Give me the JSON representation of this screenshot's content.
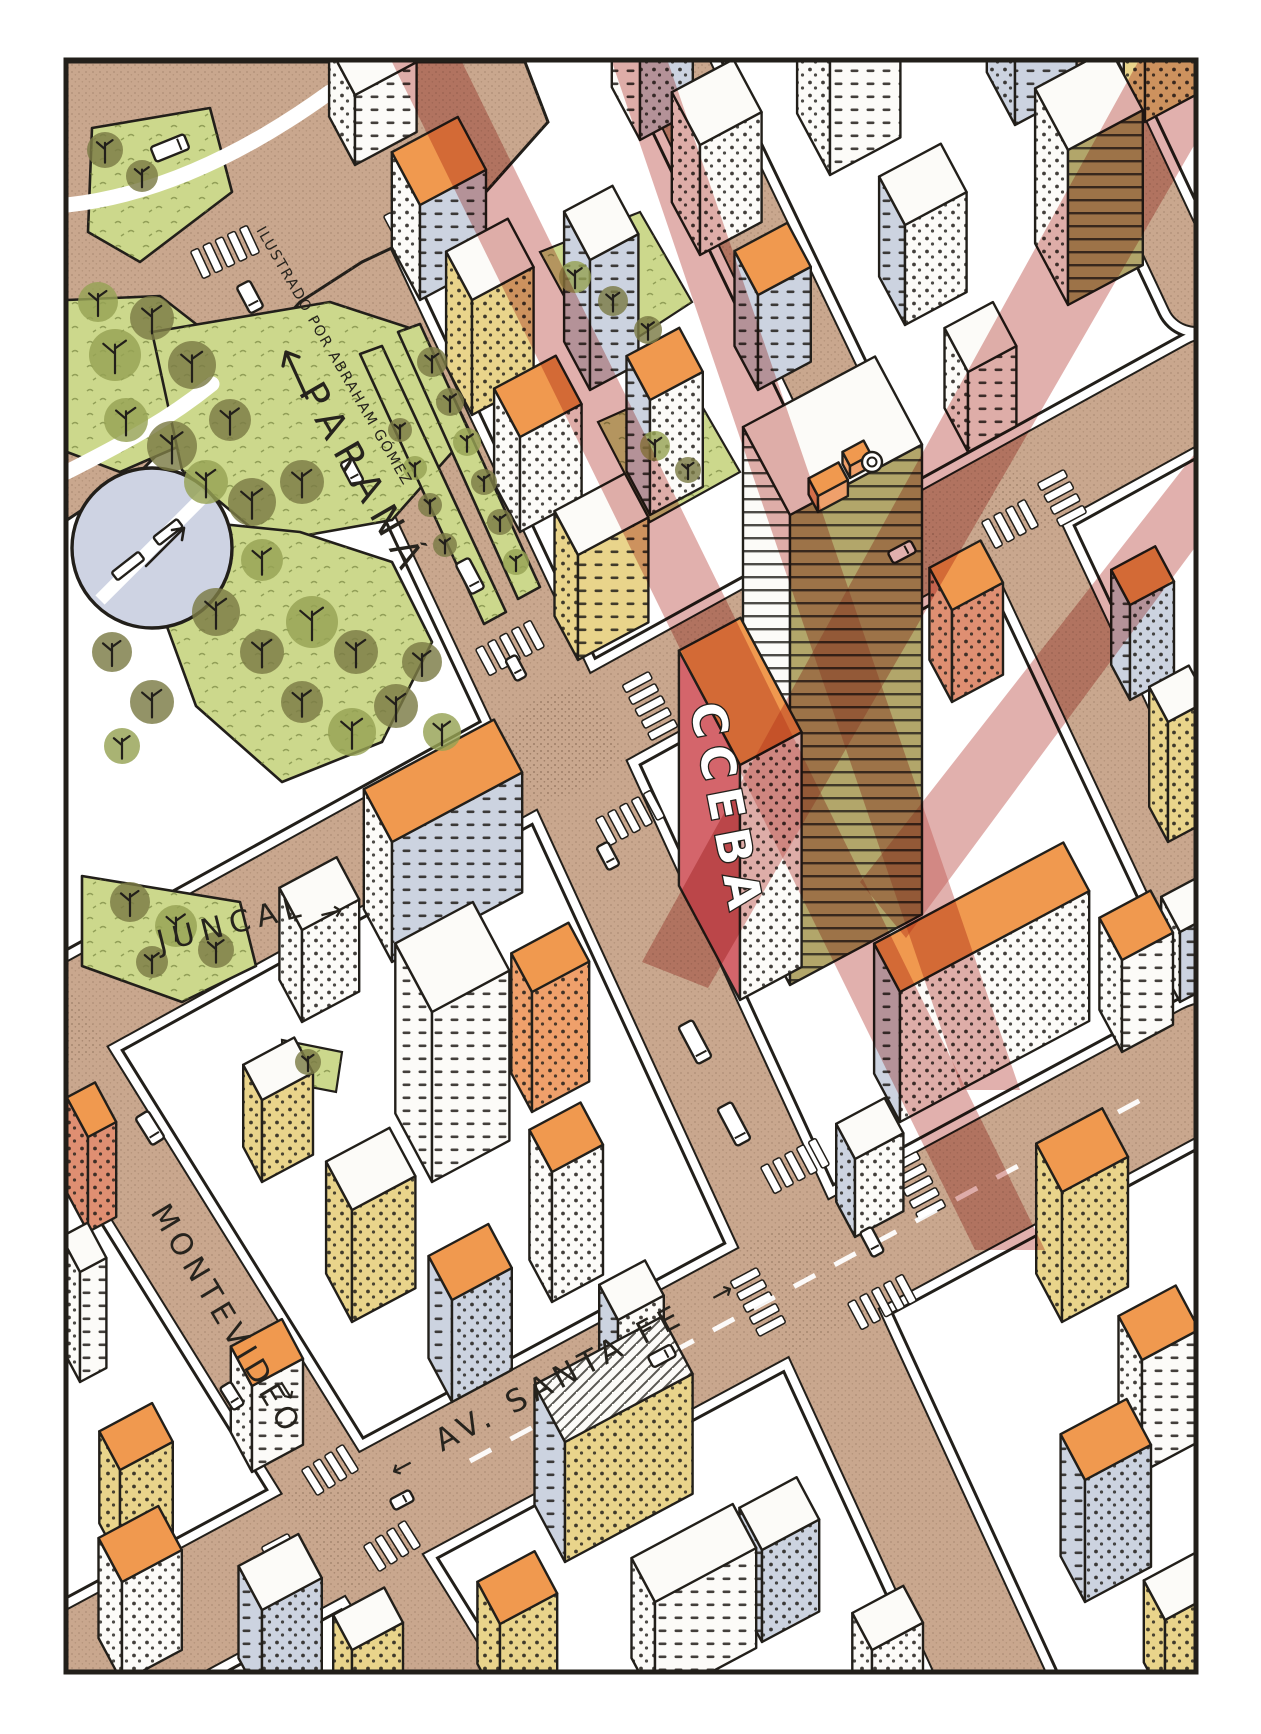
{
  "credit": {
    "text": "ILUSTRADO POR ABRAHAM GÓMEZ"
  },
  "streets": {
    "parana": {
      "name": "PARANÁ",
      "arrow": "↑"
    },
    "juncal": {
      "name": "JUNCAL",
      "arrow": "→"
    },
    "montevideo": {
      "name": "MONTEVIDEO",
      "arrow": "↓"
    },
    "santa_fe": {
      "name": "AV. SANTA FE",
      "arrow_left": "←",
      "arrow_right": "→"
    }
  },
  "landmark": {
    "sign": "CCEBA"
  },
  "palette": {
    "ink": "#221f1a",
    "paper": "#ffffff",
    "street": "#c9a78e",
    "street_dot": "#8f7058",
    "park_green": "#ccd88c",
    "grass_mark": "#6a7a35",
    "tree": "#7b7b45",
    "tree_alt": "#96a254",
    "plaza_circle": "#ced3e3",
    "wall_white": "#fcfbf8",
    "wall_gray": "#ccd3e0",
    "wall_yellow": "#e9d48b",
    "wall_olive": "#b2a66a",
    "wall_salmon": "#df8f72",
    "wall_orange": "#efa06b",
    "roof_orange": "#f0994f",
    "sign_red": "#d4656b",
    "beam_red": "#c4625c"
  }
}
